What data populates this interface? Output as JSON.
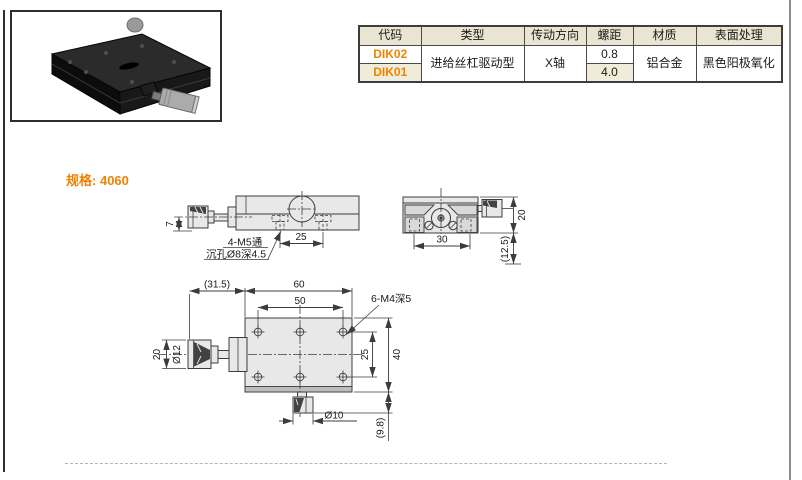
{
  "colors": {
    "accent_orange": "#ef8200",
    "table_header_bg": "#e9e5d2",
    "table_alt_row_bg": "#f0ecda",
    "drawing_line": "#3c3c3c",
    "drawing_fill": "#e8e8e8"
  },
  "product_table": {
    "headers": [
      "代码",
      "类型",
      "传动方向",
      "螺距",
      "材质",
      "表面处理"
    ],
    "rows": [
      {
        "code": "DIK02",
        "pitch": "0.8"
      },
      {
        "code": "DIK01",
        "pitch": "4.0"
      }
    ],
    "shared": {
      "type": "进给丝杠驱动型",
      "drive_direction": "X轴",
      "material": "铝合金",
      "surface_finish": "黑色阳极氧化"
    }
  },
  "spec": {
    "label": "规格:",
    "value": "4060"
  },
  "drawings": {
    "side_view": {
      "dim_height": "7",
      "dim_hole_pitch": "25",
      "note_line1": "4-M5通",
      "note_line2": "沉孔Ø8深4.5"
    },
    "end_view": {
      "dim_width": "30",
      "dim_height": "20",
      "dim_ref_height": "(12.5)"
    },
    "plan_view": {
      "dim_knob_len": "(31.5)",
      "dim_body_len": "60",
      "dim_hole_span": "50",
      "note_holes": "6-M4深5",
      "dim_knob_dia": "20",
      "dim_shaft_dia": "Ø12",
      "dim_hole_pitch": "25",
      "dim_body_width": "40",
      "dim_lock_dia": "Ø10",
      "dim_ref_bottom": "(9.8)"
    }
  }
}
